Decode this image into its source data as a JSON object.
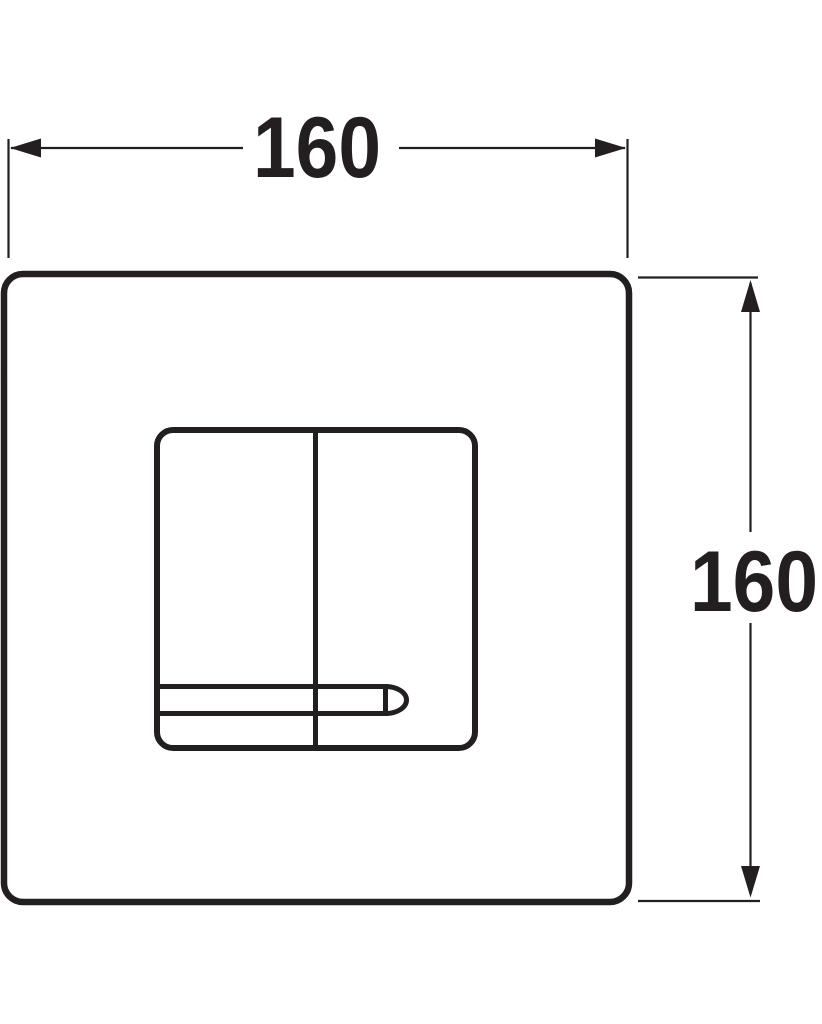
{
  "drawing": {
    "width_dimension": {
      "label": "160"
    },
    "height_dimension": {
      "label": "160"
    },
    "colors": {
      "line": "#231f20",
      "background": "#ffffff"
    },
    "icons": {
      "dim_arrow_left": "filled-triangle-left",
      "dim_arrow_right": "filled-triangle-right",
      "dim_arrow_up": "filled-triangle-up",
      "dim_arrow_down": "filled-triangle-down"
    }
  }
}
